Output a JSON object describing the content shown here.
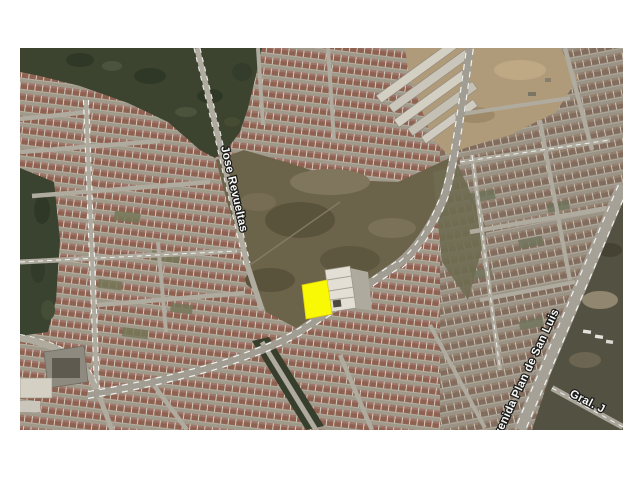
{
  "page": {
    "background": "#ffffff"
  },
  "map": {
    "kind": "satellite-aerial-photo",
    "subject": "residential development with highlighted vacant lot",
    "street_labels": [
      {
        "id": "jose-revueltas",
        "text": "Jose Revueltas"
      },
      {
        "id": "avenida-plan-de-san-luis",
        "text": "Avenida Plan de San Luis"
      },
      {
        "id": "gral",
        "text": "Gral. J"
      }
    ],
    "highlight_parcel": {
      "color": "#ffff00",
      "description": "yellow highlighted lot beside white building"
    },
    "palette": {
      "vegetation": "#38402c",
      "vegetation_dark": "#2b3323",
      "dirt_lot": "#6b6149",
      "construction_dirt": "#b29b7a",
      "scrub": "#514f40",
      "road": "#b0aca1",
      "road_minor": "#b2ada2",
      "road_marking": "#ffffff",
      "roof_red": "#8f5f50",
      "roof_red_light": "#a1746a",
      "roof_gray": "#826b5c",
      "walls": "#d8d2c5",
      "residential_base": "#a29b8d"
    }
  }
}
